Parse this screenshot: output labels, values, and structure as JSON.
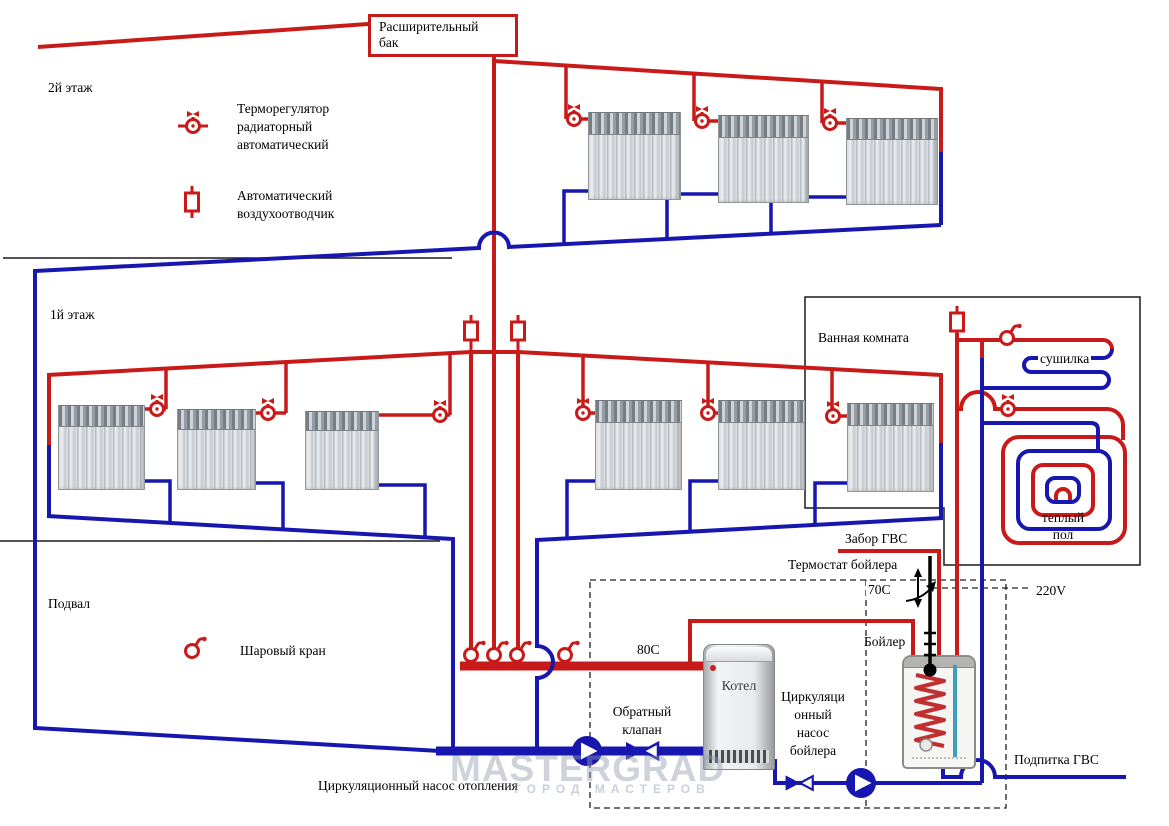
{
  "title": "Схема отопления двухэтажного дома",
  "colors": {
    "supply_red": "#c91a1a",
    "return_blue": "#1717b0",
    "line_black": "#1a1a1a"
  },
  "labels": {
    "expansion_tank": "Расширительный\nбак",
    "floor2": "2й этаж",
    "floor1": "1й этаж",
    "basement": "Подвал",
    "bathroom": "Ванная комната",
    "dryer": "сушилка",
    "warm_floor": "теплый\nпол",
    "dhw_draw": "Забор ГВС",
    "thermostat": "Термостат бойлера",
    "temp_boiler": "70C",
    "voltage": "220V",
    "boiler_tank": "Бойлер",
    "temp_supply": "80C",
    "boiler": "Котел",
    "check_valve": "Обратный\nклапан",
    "boiler_pump": "Циркуляци\nонный\nнасос\nбойлера",
    "heating_pump": "Циркуляционный насос отопления",
    "dhw_makeup": "Подпитка ГВС",
    "watermark": "MASTERGRAD",
    "watermark2": "ГОРОД МАСТЕРОВ"
  },
  "legend": {
    "thermo_valve": "Терморегулятор\nрадиаторный\nавтоматический",
    "air_vent": "Автоматический\nвоздухоотводчик",
    "ball_valve": "Шаровый кран"
  },
  "components": {
    "radiators_floor2": 3,
    "radiators_floor1": 6,
    "icons": [
      "thermo-valve-icon",
      "air-vent-icon",
      "ball-valve-icon",
      "pump-icon",
      "check-valve-icon",
      "thermostat-probe-icon"
    ]
  }
}
